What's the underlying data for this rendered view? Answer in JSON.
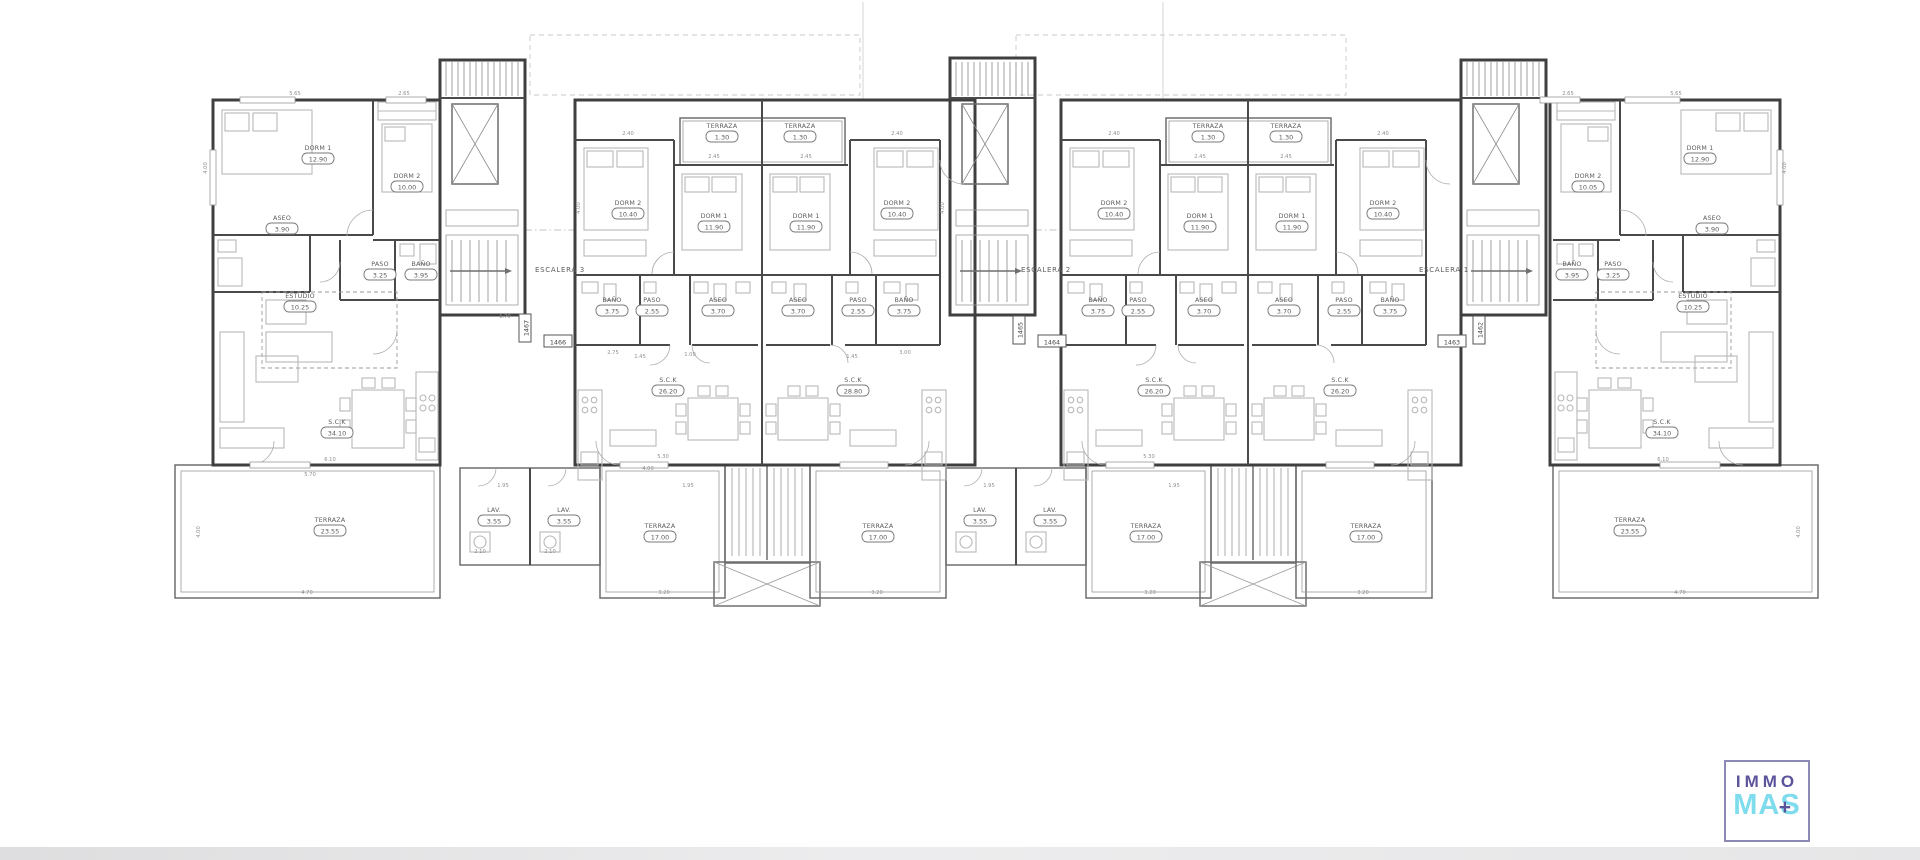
{
  "page": {
    "background": "#ffffff"
  },
  "logo": {
    "line1": "IMMO",
    "line2": "MAS",
    "plus": "+",
    "border_color": "#8d89b5",
    "immo_color": "#5b549b",
    "mas_color": "#7fdcec"
  },
  "plan": {
    "stairwells": [
      {
        "label": "ESCALERA 3",
        "x": 560,
        "y": 272
      },
      {
        "label": "ESCALERA 2",
        "x": 1046,
        "y": 272
      },
      {
        "label": "ESCALERA 1",
        "x": 1444,
        "y": 272
      }
    ],
    "unit_tags": [
      {
        "v": "1467",
        "x": 528,
        "y": 328,
        "r": -90
      },
      {
        "v": "1466",
        "x": 558,
        "y": 344,
        "r": 0
      },
      {
        "v": "1465",
        "x": 1022,
        "y": 330,
        "r": -90
      },
      {
        "v": "1464",
        "x": 1052,
        "y": 344,
        "r": 0
      },
      {
        "v": "1463",
        "x": 1452,
        "y": 344,
        "r": 0
      },
      {
        "v": "1462",
        "x": 1482,
        "y": 330,
        "r": -90
      }
    ],
    "rooms": [
      {
        "u": "end-left",
        "n": "DORM 1",
        "a": "12.90",
        "x": 318,
        "y": 150
      },
      {
        "u": "end-left",
        "n": "DORM 2",
        "a": "10.00",
        "x": 407,
        "y": 178
      },
      {
        "u": "end-left",
        "n": "ASEO",
        "a": "3.90",
        "x": 282,
        "y": 220
      },
      {
        "u": "end-left",
        "n": "PASO",
        "a": "3.25",
        "x": 380,
        "y": 266
      },
      {
        "u": "end-left",
        "n": "BAÑO",
        "a": "3.95",
        "x": 421,
        "y": 266
      },
      {
        "u": "end-left",
        "n": "ESTUDIO",
        "a": "10.25",
        "x": 300,
        "y": 298
      },
      {
        "u": "end-left",
        "n": "S.C.K",
        "a": "34.10",
        "x": 337,
        "y": 424
      },
      {
        "u": "end-left",
        "n": "TERRAZA",
        "a": "23.55",
        "x": 330,
        "y": 522
      },
      {
        "u": "unit-a",
        "n": "TERRAZA",
        "a": "1.30",
        "x": 722,
        "y": 128
      },
      {
        "u": "unit-a",
        "n": "DORM 2",
        "a": "10.40",
        "x": 628,
        "y": 205
      },
      {
        "u": "unit-a",
        "n": "DORM 1",
        "a": "11.90",
        "x": 714,
        "y": 218
      },
      {
        "u": "unit-a",
        "n": "BAÑO",
        "a": "3.75",
        "x": 612,
        "y": 302
      },
      {
        "u": "unit-a",
        "n": "PASO",
        "a": "2.55",
        "x": 652,
        "y": 302
      },
      {
        "u": "unit-a",
        "n": "ASEO",
        "a": "3.70",
        "x": 718,
        "y": 302
      },
      {
        "u": "unit-a",
        "n": "S.C.K",
        "a": "26.20",
        "x": 668,
        "y": 382
      },
      {
        "u": "unit-a",
        "n": "LAV.",
        "a": "3.55",
        "x": 494,
        "y": 512
      },
      {
        "u": "unit-a",
        "n": "TERRAZA",
        "a": "17.00",
        "x": 660,
        "y": 528
      },
      {
        "u": "unit-b",
        "n": "TERRAZA",
        "a": "1.30",
        "x": 800,
        "y": 128
      },
      {
        "u": "unit-b",
        "n": "DORM 1",
        "a": "11.90",
        "x": 806,
        "y": 218
      },
      {
        "u": "unit-b",
        "n": "DORM 2",
        "a": "10.40",
        "x": 897,
        "y": 205
      },
      {
        "u": "unit-b",
        "n": "ASEO",
        "a": "3.70",
        "x": 798,
        "y": 302
      },
      {
        "u": "unit-b",
        "n": "PASO",
        "a": "2.55",
        "x": 858,
        "y": 302
      },
      {
        "u": "unit-b",
        "n": "BAÑO",
        "a": "3.75",
        "x": 904,
        "y": 302
      },
      {
        "u": "unit-b",
        "n": "S.C.K",
        "a": "28.80",
        "x": 853,
        "y": 382
      },
      {
        "u": "unit-b",
        "n": "LAV.",
        "a": "3.55",
        "x": 564,
        "y": 512
      },
      {
        "u": "unit-b",
        "n": "TERRAZA",
        "a": "17.00",
        "x": 878,
        "y": 528
      },
      {
        "u": "unit-c",
        "n": "TERRAZA",
        "a": "1.30",
        "x": 1208,
        "y": 128
      },
      {
        "u": "unit-c",
        "n": "DORM 2",
        "a": "10.40",
        "x": 1114,
        "y": 205
      },
      {
        "u": "unit-c",
        "n": "DORM 1",
        "a": "11.90",
        "x": 1200,
        "y": 218
      },
      {
        "u": "unit-c",
        "n": "BAÑO",
        "a": "3.75",
        "x": 1098,
        "y": 302
      },
      {
        "u": "unit-c",
        "n": "PASO",
        "a": "2.55",
        "x": 1138,
        "y": 302
      },
      {
        "u": "unit-c",
        "n": "ASEO",
        "a": "3.70",
        "x": 1204,
        "y": 302
      },
      {
        "u": "unit-c",
        "n": "S.C.K",
        "a": "26.20",
        "x": 1154,
        "y": 382
      },
      {
        "u": "unit-c",
        "n": "LAV.",
        "a": "3.55",
        "x": 980,
        "y": 512
      },
      {
        "u": "unit-c",
        "n": "TERRAZA",
        "a": "17.00",
        "x": 1146,
        "y": 528
      },
      {
        "u": "unit-d",
        "n": "TERRAZA",
        "a": "1.30",
        "x": 1286,
        "y": 128
      },
      {
        "u": "unit-d",
        "n": "DORM 1",
        "a": "11.90",
        "x": 1292,
        "y": 218
      },
      {
        "u": "unit-d",
        "n": "DORM 2",
        "a": "10.40",
        "x": 1383,
        "y": 205
      },
      {
        "u": "unit-d",
        "n": "ASEO",
        "a": "3.70",
        "x": 1284,
        "y": 302
      },
      {
        "u": "unit-d",
        "n": "PASO",
        "a": "2.55",
        "x": 1344,
        "y": 302
      },
      {
        "u": "unit-d",
        "n": "BAÑO",
        "a": "3.75",
        "x": 1390,
        "y": 302
      },
      {
        "u": "unit-d",
        "n": "S.C.K",
        "a": "26.20",
        "x": 1340,
        "y": 382
      },
      {
        "u": "unit-d",
        "n": "LAV.",
        "a": "3.55",
        "x": 1050,
        "y": 512
      },
      {
        "u": "unit-d",
        "n": "TERRAZA",
        "a": "17.00",
        "x": 1366,
        "y": 528
      },
      {
        "u": "end-right",
        "n": "DORM 2",
        "a": "10.05",
        "x": 1588,
        "y": 178
      },
      {
        "u": "end-right",
        "n": "DORM 1",
        "a": "12.90",
        "x": 1700,
        "y": 150
      },
      {
        "u": "end-right",
        "n": "ASEO",
        "a": "3.90",
        "x": 1712,
        "y": 220
      },
      {
        "u": "end-right",
        "n": "BAÑO",
        "a": "3.95",
        "x": 1572,
        "y": 266
      },
      {
        "u": "end-right",
        "n": "PASO",
        "a": "3.25",
        "x": 1613,
        "y": 266
      },
      {
        "u": "end-right",
        "n": "ESTUDIO",
        "a": "10.25",
        "x": 1693,
        "y": 298
      },
      {
        "u": "end-right",
        "n": "S.C.K",
        "a": "34.10",
        "x": 1662,
        "y": 424
      },
      {
        "u": "end-right",
        "n": "TERRAZA",
        "a": "23.55",
        "x": 1630,
        "y": 522
      }
    ],
    "dims": [
      {
        "v": "5.65",
        "x": 295,
        "y": 95
      },
      {
        "v": "2.65",
        "x": 404,
        "y": 95
      },
      {
        "v": "4.00",
        "x": 207,
        "y": 168,
        "r": -90
      },
      {
        "v": "2.40",
        "x": 628,
        "y": 135
      },
      {
        "v": "2.45",
        "x": 714,
        "y": 158
      },
      {
        "v": "2.45",
        "x": 806,
        "y": 158
      },
      {
        "v": "2.40",
        "x": 897,
        "y": 135
      },
      {
        "v": "4.00",
        "x": 580,
        "y": 208,
        "r": -90
      },
      {
        "v": "4.00",
        "x": 944,
        "y": 208,
        "r": -90
      },
      {
        "v": "1.70",
        "x": 505,
        "y": 318
      },
      {
        "v": "1.45",
        "x": 640,
        "y": 358
      },
      {
        "v": "1.00",
        "x": 690,
        "y": 356
      },
      {
        "v": "2.75",
        "x": 613,
        "y": 354
      },
      {
        "v": "1.45",
        "x": 852,
        "y": 358
      },
      {
        "v": "3.00",
        "x": 905,
        "y": 354
      },
      {
        "v": "1.95",
        "x": 503,
        "y": 487
      },
      {
        "v": "1.95",
        "x": 688,
        "y": 487
      },
      {
        "v": "2.10",
        "x": 480,
        "y": 553
      },
      {
        "v": "2.10",
        "x": 550,
        "y": 553
      },
      {
        "v": "5.30",
        "x": 663,
        "y": 458
      },
      {
        "v": "4.00",
        "x": 648,
        "y": 470
      },
      {
        "v": "3.20",
        "x": 664,
        "y": 594
      },
      {
        "v": "3.20",
        "x": 877,
        "y": 594
      },
      {
        "v": "6.10",
        "x": 330,
        "y": 461
      },
      {
        "v": "5.70",
        "x": 310,
        "y": 476
      },
      {
        "v": "4.70",
        "x": 307,
        "y": 594
      },
      {
        "v": "4.00",
        "x": 200,
        "y": 532,
        "r": -90
      },
      {
        "v": "1.95",
        "x": 989,
        "y": 487
      },
      {
        "v": "1.95",
        "x": 1174,
        "y": 487
      },
      {
        "v": "3.20",
        "x": 1150,
        "y": 594
      },
      {
        "v": "3.20",
        "x": 1363,
        "y": 594
      },
      {
        "v": "5.30",
        "x": 1149,
        "y": 458
      },
      {
        "v": "2.65",
        "x": 1568,
        "y": 95
      },
      {
        "v": "5.65",
        "x": 1676,
        "y": 95
      },
      {
        "v": "4.00",
        "x": 1786,
        "y": 168,
        "r": -90
      },
      {
        "v": "6.10",
        "x": 1663,
        "y": 461
      },
      {
        "v": "4.70",
        "x": 1680,
        "y": 594
      },
      {
        "v": "4.00",
        "x": 1800,
        "y": 532,
        "r": -90
      },
      {
        "v": "2.40",
        "x": 1114,
        "y": 135
      },
      {
        "v": "2.45",
        "x": 1200,
        "y": 158
      },
      {
        "v": "2.45",
        "x": 1286,
        "y": 158
      },
      {
        "v": "2.40",
        "x": 1383,
        "y": 135
      }
    ]
  }
}
